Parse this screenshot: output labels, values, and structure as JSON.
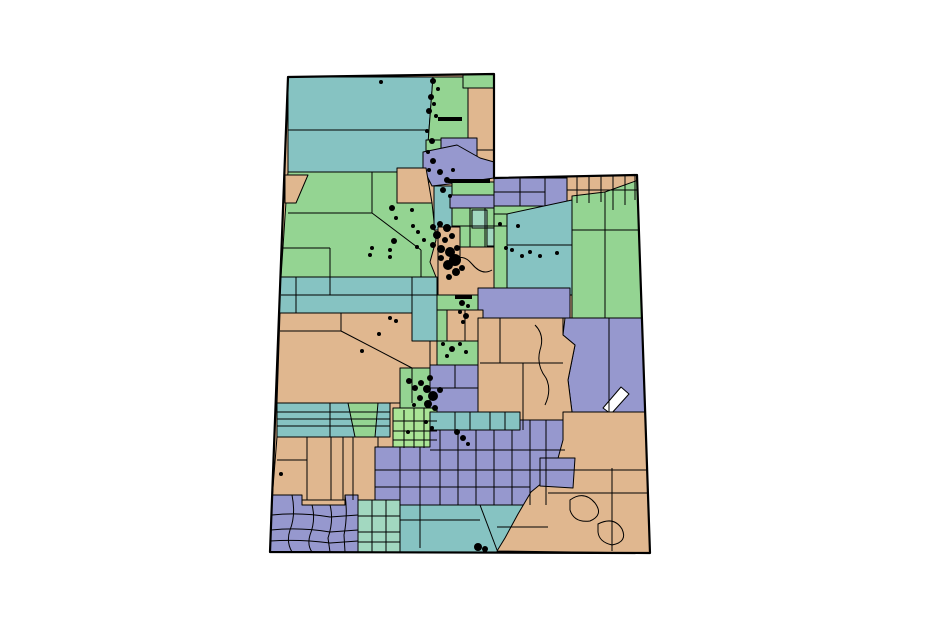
{
  "meta": {
    "width": 940,
    "height": 639,
    "background": "#ffffff"
  },
  "map": {
    "name": "utah-regions-choropleth",
    "stroke": "#000000",
    "region_stroke_width": 1,
    "outline_stroke_width": 2.2,
    "palette": {
      "teal": "#86c3c2",
      "green": "#94d492",
      "purple": "#9698ce",
      "tan": "#e0b78f",
      "lightgreen": "#aae496",
      "mint": "#a2d8c0",
      "white": "#ffffff",
      "black": "#000000"
    },
    "outline": "288,77 494,74 494,178 637,175 650,553 270,552",
    "regions": [
      {
        "c": "tan",
        "p": "288,77 494,74 494,178 637,175 650,553 270,552"
      },
      {
        "c": "teal",
        "p": "288,77 433,77 429,130 288,130"
      },
      {
        "c": "teal",
        "p": "288,130 429,130 426,172 288,172"
      },
      {
        "c": "green",
        "p": "433,77 470,77 470,140 455,172 426,172 429,130"
      },
      {
        "c": "green",
        "p": "463,74 494,74 494,88 463,88"
      },
      {
        "c": "tan",
        "p": "468,88 494,88 494,150 468,150"
      },
      {
        "c": "green",
        "p": "426,140 465,140 463,182 426,182"
      },
      {
        "c": "purple",
        "p": "441,138 477,138 477,156 441,156"
      },
      {
        "c": "purple",
        "p": "423,152 457,145 480,158 494,162 494,178 458,183 432,186 423,168"
      },
      {
        "c": "tan",
        "p": "397,168 426,168 432,203 397,203"
      },
      {
        "c": "green",
        "p": "288,172 397,172 397,203 432,203 436,240 430,262 436,277 281,277"
      },
      {
        "c": "tan",
        "p": "285,175 308,175 296,203 285,203"
      },
      {
        "c": "teal",
        "p": "434,186 452,186 452,230 434,230"
      },
      {
        "c": "green",
        "p": "452,182 494,182 494,196 452,196"
      },
      {
        "c": "green",
        "p": "452,196 507,196 507,247 452,247"
      },
      {
        "c": "purple",
        "p": "450,195 507,195 507,208 450,208"
      },
      {
        "c": "mint",
        "p": "472,210 487,210 487,228 472,228"
      },
      {
        "c": "mint",
        "p": "487,228 501,228 501,246 487,246"
      },
      {
        "c": "tan",
        "p": "438,227 460,227 460,247 512,247 512,298 438,298"
      },
      {
        "c": "green",
        "p": "437,295 478,295 478,310 437,310"
      },
      {
        "c": "purple",
        "p": "494,178 567,178 567,206 494,206"
      },
      {
        "c": "tan",
        "p": "567,175 644,175 645,200 628,200 622,212 606,210 600,200 567,203"
      },
      {
        "c": "green",
        "p": "494,206 567,206 567,214 494,214"
      },
      {
        "c": "green",
        "p": "494,214 507,214 507,302 494,302"
      },
      {
        "c": "teal",
        "p": "507,214 572,200 572,295 507,295"
      },
      {
        "c": "green",
        "p": "572,196 605,192 605,318 572,318"
      },
      {
        "c": "green",
        "p": "605,192 644,178 643,318 605,318"
      },
      {
        "c": "purple",
        "p": "478,288 570,288 570,318 478,318"
      },
      {
        "c": "teal",
        "p": "280,277 412,277 412,313 279,313"
      },
      {
        "c": "teal",
        "p": "412,277 437,277 437,341 412,341"
      },
      {
        "c": "tan",
        "p": "280,313 412,313 412,341 430,341 430,403 277,403"
      },
      {
        "c": "tan",
        "p": "447,310 483,310 483,341 447,341"
      },
      {
        "c": "green",
        "p": "437,310 447,310 447,341 437,341"
      },
      {
        "c": "green",
        "p": "437,341 478,341 478,365 437,365"
      },
      {
        "c": "green",
        "p": "400,368 430,368 430,412 400,412"
      },
      {
        "c": "purple",
        "p": "430,365 478,365 478,412 430,412"
      },
      {
        "c": "purple",
        "p": "565,318 643,318 646,412 572,412 568,380 575,345 563,335"
      },
      {
        "c": "tan",
        "p": "478,318 563,318 563,335 575,345 568,380 572,412 560,430 478,430"
      },
      {
        "c": "white",
        "p": "603,408 621,387 629,394 611,414"
      },
      {
        "c": "lightgreen",
        "p": "393,408 437,408 437,448 393,448"
      },
      {
        "c": "teal",
        "p": "277,403 390,403 390,437 277,437"
      },
      {
        "c": "green",
        "p": "348,403 378,403 375,437 355,437"
      },
      {
        "c": "tan",
        "p": "277,437 378,437 378,500 272,500"
      },
      {
        "c": "teal",
        "p": "430,412 520,412 520,430 430,430"
      },
      {
        "c": "purple",
        "p": "375,447 430,447 430,430 520,430 520,420 565,420 565,505 375,505"
      },
      {
        "c": "purple",
        "p": "272,495 302,495 302,505 345,505 345,495 358,495 358,554 270,552"
      },
      {
        "c": "mint",
        "p": "358,500 400,500 400,554 358,554"
      },
      {
        "c": "teal",
        "p": "400,505 560,505 548,553 400,553"
      },
      {
        "c": "tan",
        "p": "563,412 646,412 650,553 497,551 505,538 518,514 531,492 548,478 557,462 563,440"
      },
      {
        "c": "purple",
        "p": "540,458 575,458 573,488 540,486"
      }
    ],
    "lines": [
      {
        "d": "M288,213 L372,213"
      },
      {
        "d": "M372,172 L372,213"
      },
      {
        "d": "M330,248 L330,277"
      },
      {
        "d": "M283,248 L330,248"
      },
      {
        "d": "M372,213 L421,250"
      },
      {
        "d": "M421,250 L421,277"
      },
      {
        "d": "M281,295 L412,295"
      },
      {
        "d": "M296,277 L296,313"
      },
      {
        "d": "M330,277 L330,295"
      },
      {
        "d": "M412,295 L437,295"
      },
      {
        "d": "M280,331 L341,331"
      },
      {
        "d": "M341,313 L341,331"
      },
      {
        "d": "M341,331 L412,368"
      },
      {
        "d": "M412,368 L412,403"
      },
      {
        "d": "M465,310 L465,341"
      },
      {
        "d": "M470,208 L470,247"
      },
      {
        "d": "M485,208 L485,247"
      },
      {
        "d": "M452,226 L507,226"
      },
      {
        "d": "M452,262 Q462,252 472,264 T492,270"
      },
      {
        "d": "M460,247 L460,262"
      },
      {
        "d": "M520,178 L520,206"
      },
      {
        "d": "M545,178 L545,206"
      },
      {
        "d": "M494,192 L545,192"
      },
      {
        "d": "M577,175 L577,203"
      },
      {
        "d": "M589,175 L589,203"
      },
      {
        "d": "M601,175 L601,202"
      },
      {
        "d": "M613,175 L613,210"
      },
      {
        "d": "M625,175 L625,205"
      },
      {
        "d": "M635,175 L635,200"
      },
      {
        "d": "M567,190 L644,190"
      },
      {
        "d": "M507,245 L572,245"
      },
      {
        "d": "M572,230 L643,230"
      },
      {
        "d": "M609,318 L609,412"
      },
      {
        "d": "M480,363 L563,363"
      },
      {
        "d": "M523,363 L523,430"
      },
      {
        "d": "M500,318 L500,363"
      },
      {
        "d": "M535,325 Q545,335 540,350 Q536,365 546,378 Q552,390 545,405"
      },
      {
        "d": "M430,388 L478,388"
      },
      {
        "d": "M455,365 L455,388"
      },
      {
        "d": "M404,410 L404,448"
      },
      {
        "d": "M414,408 L414,448"
      },
      {
        "d": "M424,408 L424,448"
      },
      {
        "d": "M393,421 L437,421"
      },
      {
        "d": "M393,431 L437,431"
      },
      {
        "d": "M393,440 L437,440"
      },
      {
        "d": "M277,412 L390,412"
      },
      {
        "d": "M277,419 L390,419"
      },
      {
        "d": "M277,426 L390,426"
      },
      {
        "d": "M330,403 L330,437"
      },
      {
        "d": "M307,437 L307,500"
      },
      {
        "d": "M331,437 L331,500"
      },
      {
        "d": "M343,437 L343,500"
      },
      {
        "d": "M353,437 L353,500"
      },
      {
        "d": "M277,460 L307,460"
      },
      {
        "d": "M400,447 L400,505"
      },
      {
        "d": "M420,447 L420,505"
      },
      {
        "d": "M440,430 L440,505"
      },
      {
        "d": "M458,430 L458,505"
      },
      {
        "d": "M476,430 L476,505"
      },
      {
        "d": "M494,430 L494,505"
      },
      {
        "d": "M512,430 L512,505"
      },
      {
        "d": "M530,420 L530,505"
      },
      {
        "d": "M546,420 L546,505"
      },
      {
        "d": "M375,470 L565,470"
      },
      {
        "d": "M375,487 L530,487"
      },
      {
        "d": "M430,450 L565,450"
      },
      {
        "d": "M292,495 Q296,515 290,530 Q286,542 292,552"
      },
      {
        "d": "M312,505 Q316,520 310,535 Q307,545 312,552"
      },
      {
        "d": "M330,505 Q334,520 328,538 L330,552"
      },
      {
        "d": "M345,495 Q348,515 344,535 L345,552"
      },
      {
        "d": "M272,515 Q300,512 330,517 L358,515"
      },
      {
        "d": "M271,530 Q300,527 330,532 L358,530"
      },
      {
        "d": "M270,541 Q300,539 330,543 L358,541"
      },
      {
        "d": "M372,500 L372,553"
      },
      {
        "d": "M386,500 L386,553"
      },
      {
        "d": "M358,516 L400,516"
      },
      {
        "d": "M358,532 L400,532"
      },
      {
        "d": "M358,542 L400,542"
      },
      {
        "d": "M480,505 L497,550"
      },
      {
        "d": "M400,520 L480,520"
      },
      {
        "d": "M420,505 L420,548"
      },
      {
        "d": "M497,527 L548,527"
      },
      {
        "d": "M548,470 L650,470"
      },
      {
        "d": "M612,468 L612,551"
      },
      {
        "d": "M548,493 L650,493"
      },
      {
        "d": "M570,500 Q584,490 595,503 Q604,515 590,521 Q574,523 570,510 Z"
      },
      {
        "d": "M598,524 Q614,516 622,529 Q628,542 612,545 Q599,542 598,532 Z"
      },
      {
        "d": "M455,412 L455,430"
      },
      {
        "d": "M470,412 L470,430"
      },
      {
        "d": "M490,412 L490,430"
      },
      {
        "d": "M505,412 L505,430"
      }
    ],
    "dashes": [
      {
        "p": "438,117 462,117 462,121 438,121"
      },
      {
        "p": "448,179 490,179 490,183 448,183"
      },
      {
        "p": "455,295 472,295 472,299 455,299"
      }
    ],
    "dots": [
      [
        381,
        82,
        2
      ],
      [
        433,
        81,
        3
      ],
      [
        438,
        89,
        2
      ],
      [
        431,
        97,
        3
      ],
      [
        434,
        104,
        2
      ],
      [
        429,
        111,
        3
      ],
      [
        436,
        116,
        2
      ],
      [
        427,
        131,
        2
      ],
      [
        432,
        141,
        3
      ],
      [
        428,
        152,
        2
      ],
      [
        433,
        161,
        3
      ],
      [
        429,
        170,
        2
      ],
      [
        440,
        172,
        3
      ],
      [
        447,
        180,
        3
      ],
      [
        453,
        170,
        2
      ],
      [
        443,
        190,
        3
      ],
      [
        450,
        196,
        2
      ],
      [
        433,
        227,
        3
      ],
      [
        440,
        224,
        3
      ],
      [
        447,
        228,
        4
      ],
      [
        437,
        235,
        4
      ],
      [
        445,
        240,
        3
      ],
      [
        452,
        236,
        3
      ],
      [
        433,
        245,
        3
      ],
      [
        441,
        249,
        4
      ],
      [
        450,
        252,
        5
      ],
      [
        455,
        260,
        6
      ],
      [
        448,
        265,
        5
      ],
      [
        456,
        272,
        4
      ],
      [
        449,
        277,
        3
      ],
      [
        441,
        258,
        3
      ],
      [
        457,
        248,
        3
      ],
      [
        462,
        268,
        3
      ],
      [
        413,
        226,
        2
      ],
      [
        418,
        232,
        2
      ],
      [
        424,
        240,
        2
      ],
      [
        417,
        247,
        2
      ],
      [
        412,
        210,
        2
      ],
      [
        392,
        208,
        3
      ],
      [
        396,
        218,
        2
      ],
      [
        394,
        241,
        3
      ],
      [
        390,
        250,
        2
      ],
      [
        372,
        248,
        2
      ],
      [
        370,
        255,
        2
      ],
      [
        390,
        257,
        2
      ],
      [
        500,
        224,
        2
      ],
      [
        506,
        248,
        2
      ],
      [
        512,
        250,
        2
      ],
      [
        522,
        256,
        2
      ],
      [
        530,
        252,
        2
      ],
      [
        518,
        226,
        2
      ],
      [
        462,
        303,
        3
      ],
      [
        468,
        306,
        2
      ],
      [
        460,
        312,
        2
      ],
      [
        466,
        316,
        3
      ],
      [
        463,
        322,
        2
      ],
      [
        540,
        256,
        2
      ],
      [
        557,
        253,
        2
      ],
      [
        390,
        318,
        2
      ],
      [
        396,
        321,
        2
      ],
      [
        379,
        334,
        2
      ],
      [
        362,
        351,
        2
      ],
      [
        443,
        344,
        2
      ],
      [
        452,
        349,
        3
      ],
      [
        460,
        344,
        2
      ],
      [
        447,
        356,
        2
      ],
      [
        466,
        352,
        2
      ],
      [
        409,
        381,
        3
      ],
      [
        415,
        388,
        3
      ],
      [
        421,
        383,
        3
      ],
      [
        427,
        389,
        4
      ],
      [
        433,
        396,
        5
      ],
      [
        428,
        404,
        4
      ],
      [
        420,
        398,
        3
      ],
      [
        435,
        408,
        3
      ],
      [
        440,
        390,
        3
      ],
      [
        414,
        405,
        2
      ],
      [
        430,
        378,
        3
      ],
      [
        426,
        422,
        2
      ],
      [
        432,
        428,
        2
      ],
      [
        457,
        432,
        3
      ],
      [
        463,
        438,
        3
      ],
      [
        468,
        444,
        2
      ],
      [
        408,
        432,
        2
      ],
      [
        281,
        474,
        2
      ],
      [
        478,
        547,
        4
      ],
      [
        485,
        549,
        3
      ]
    ]
  }
}
